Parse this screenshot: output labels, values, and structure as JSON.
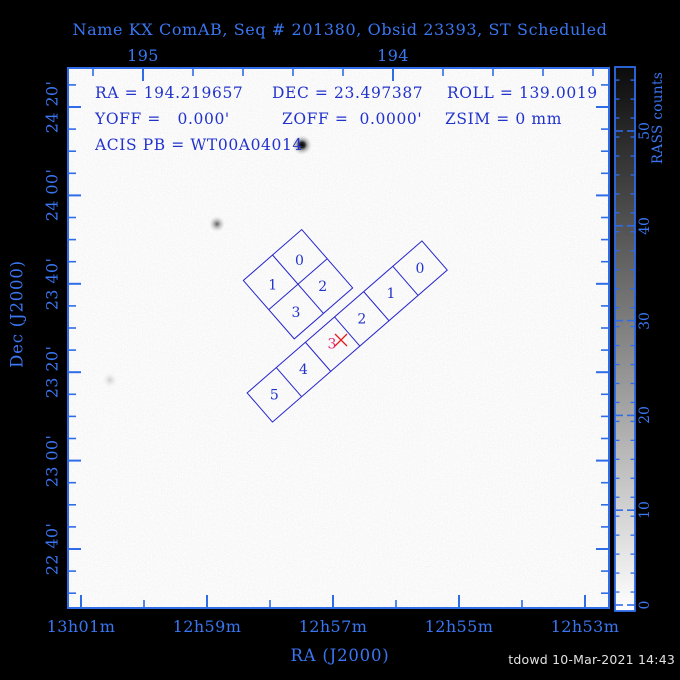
{
  "title": "Name KX ComAB, Seq # 201380, Obsid 23393, ST Scheduled",
  "info_overlay": {
    "ra": "RA = 194.219657",
    "dec": "DEC = 23.497387",
    "roll": "ROLL = 139.0019",
    "yoff": "YOFF =   0.000'",
    "zoff": "ZOFF =  0.0000'",
    "zsim": "ZSIM = 0 mm",
    "acis_pb": "ACIS PB = WT00A04014"
  },
  "footer": {
    "credit": "tdowd 10-Mar-2021 14:43"
  },
  "colors": {
    "frame_blue": "#2e6ce8",
    "label_blue_on_black": "#3a76f2",
    "text_blue_on_white": "#2233cc",
    "detector_outline_blue": "#2626cc",
    "aimpoint_label_magenta": "#e02878",
    "aimpoint_cross_red": "#e02020",
    "plot_background": "#ffffff"
  },
  "chart_data": {
    "type": "sky-map with instrument field-of-view overlay (inverted grayscale image)",
    "title": "Name KX ComAB, Seq # 201380, Obsid 23393, ST Scheduled",
    "pointing": {
      "target_name": "KX ComAB",
      "seq_number": "201380",
      "obsid": "23393",
      "status": "ST Scheduled",
      "ra_deg": 194.219657,
      "dec_deg": 23.497387,
      "roll_deg": 139.0019,
      "yoff_arcmin": "0.000",
      "zoff_arcmin": "0.0000",
      "zsim_mm": "0",
      "acis_pb": "WT00A04014"
    },
    "x_axis_top": {
      "unit": "RA degrees",
      "tick_labels": [
        "195",
        "194"
      ]
    },
    "x_axis_bottom": {
      "label": "RA (J2000)",
      "tick_labels": [
        "13h01m",
        "12h59m",
        "12h57m",
        "12h55m",
        "12h53m"
      ]
    },
    "y_axis": {
      "label": "Dec (J2000)",
      "tick_labels": [
        "24 20'",
        "24 00'",
        "23 40'",
        "23 20'",
        "23 00'",
        "22 40'"
      ]
    },
    "colorbar": {
      "label": "RASS counts",
      "tick_labels": [
        "50",
        "40",
        "30",
        "20",
        "10",
        "0"
      ],
      "value_range_top_to_bottom": [
        57,
        0
      ],
      "scale": "inverted grayscale, dark = high counts"
    },
    "detectors": {
      "acis_i": {
        "chip_labels": [
          "0",
          "1",
          "2",
          "3"
        ]
      },
      "acis_s": {
        "chip_labels": [
          "0",
          "1",
          "2",
          "3",
          "4",
          "5"
        ],
        "aimpoint_chip": "3"
      }
    },
    "sources": [
      {
        "note": "bright X-ray source",
        "px": 302,
        "py": 145,
        "strength": "bright"
      },
      {
        "note": "moderate X-ray source",
        "px": 217,
        "py": 224,
        "strength": "medium"
      },
      {
        "note": "faint X-ray source",
        "px": 110,
        "py": 380,
        "strength": "faint"
      }
    ]
  }
}
